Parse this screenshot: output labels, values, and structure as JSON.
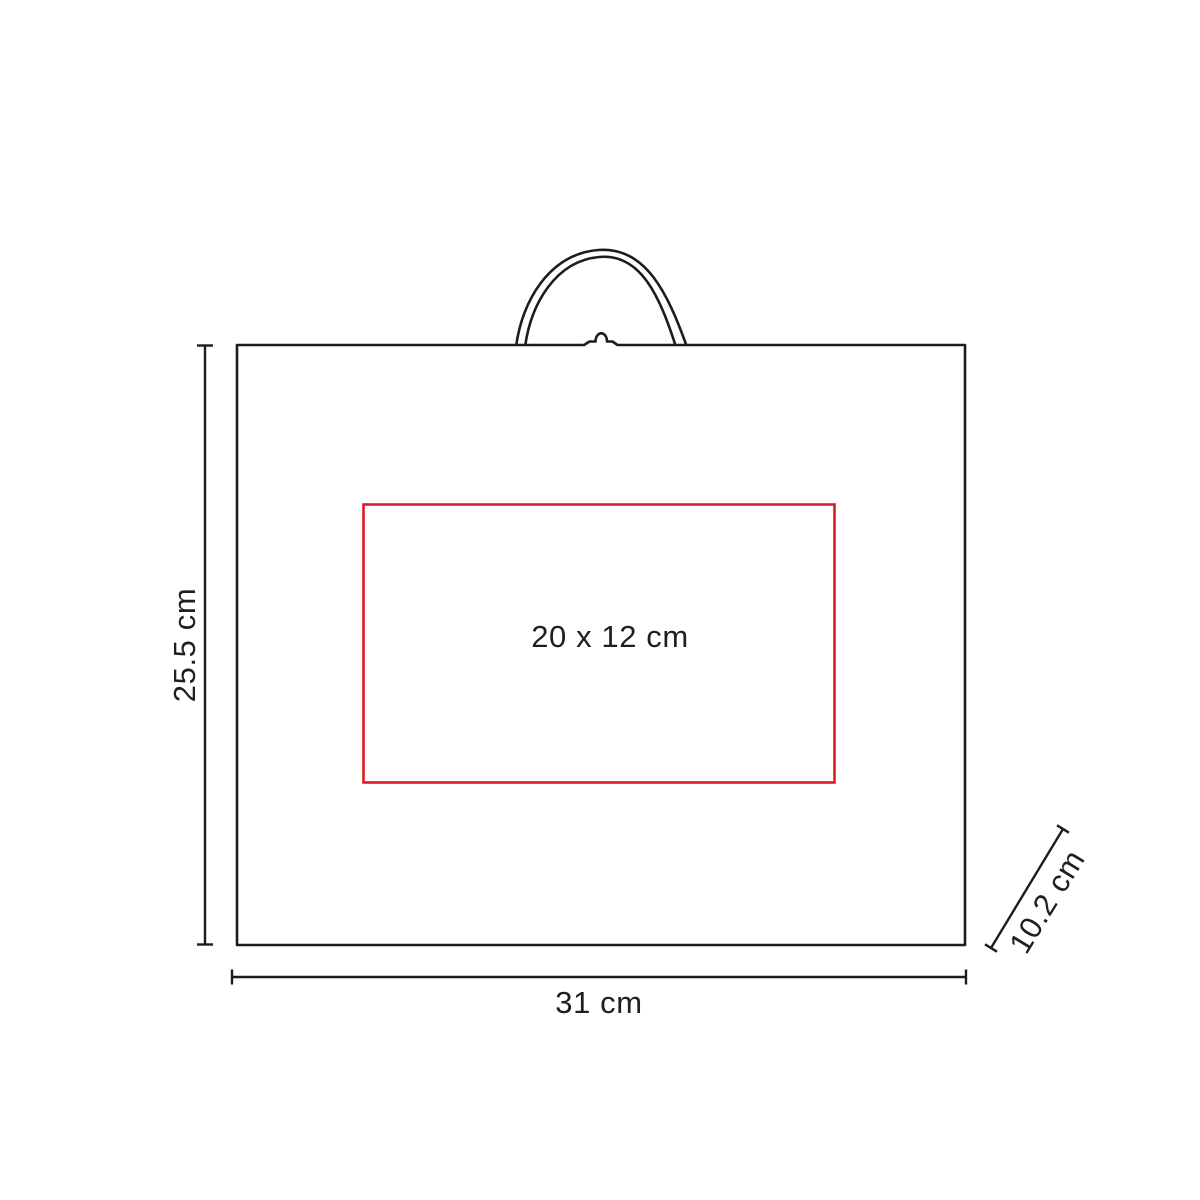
{
  "diagram": {
    "kind": "product-dimension-drawing",
    "product": "handled bag / box with carry handle, front view",
    "labels": {
      "height": "25.5 cm",
      "width": "31 cm",
      "depth": "10.2 cm",
      "print_area": "20 x 12 cm"
    },
    "colors": {
      "outline": "#1c1c1e",
      "print_area_border": "#e01b22",
      "text": "#1f1f23",
      "background": "#ffffff"
    }
  }
}
